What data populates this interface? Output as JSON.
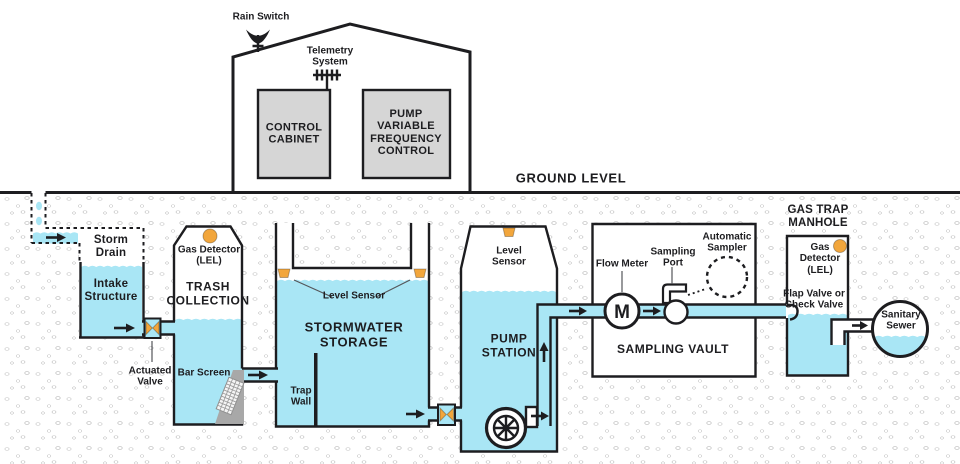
{
  "colors": {
    "water": "#A9E6F5",
    "orange": "#F2A63C",
    "ink": "#1D1D20",
    "cabinet": "#D6D6D6"
  },
  "building": {
    "rain_switch": "Rain Switch",
    "telemetry": "Telemetry\nSystem",
    "control_cabinet": "CONTROL\nCABINET",
    "pump_vfc": "PUMP\nVARIABLE\nFREQUENCY\nCONTROL"
  },
  "ground": {
    "label": "GROUND LEVEL"
  },
  "intake": {
    "storm_drain": "Storm\nDrain",
    "intake_structure": "Intake\nStructure",
    "actuated_valve": "Actuated\nValve"
  },
  "trash": {
    "gas_detector": "Gas Detector\n(LEL)",
    "title": "TRASH\nCOLLECTION",
    "bar_screen": "Bar Screen"
  },
  "storage": {
    "level_sensor": "Level Sensor",
    "title": "STORMWATER\nSTORAGE",
    "trap_wall": "Trap\nWall"
  },
  "pump": {
    "level_sensor": "Level\nSensor",
    "title": "PUMP\nSTATION"
  },
  "vault": {
    "flow_meter": "Flow Meter",
    "flow_meter_symbol": "M",
    "sampling_port": "Sampling\nPort",
    "automatic_sampler": "Automatic\nSampler",
    "title": "SAMPLING VAULT"
  },
  "manhole": {
    "title": "GAS TRAP\nMANHOLE",
    "gas_detector": "Gas\nDetector\n(LEL)",
    "flap_valve": "Flap Valve or\nCheck Valve"
  },
  "sewer": {
    "title": "Sanitary\nSewer"
  }
}
